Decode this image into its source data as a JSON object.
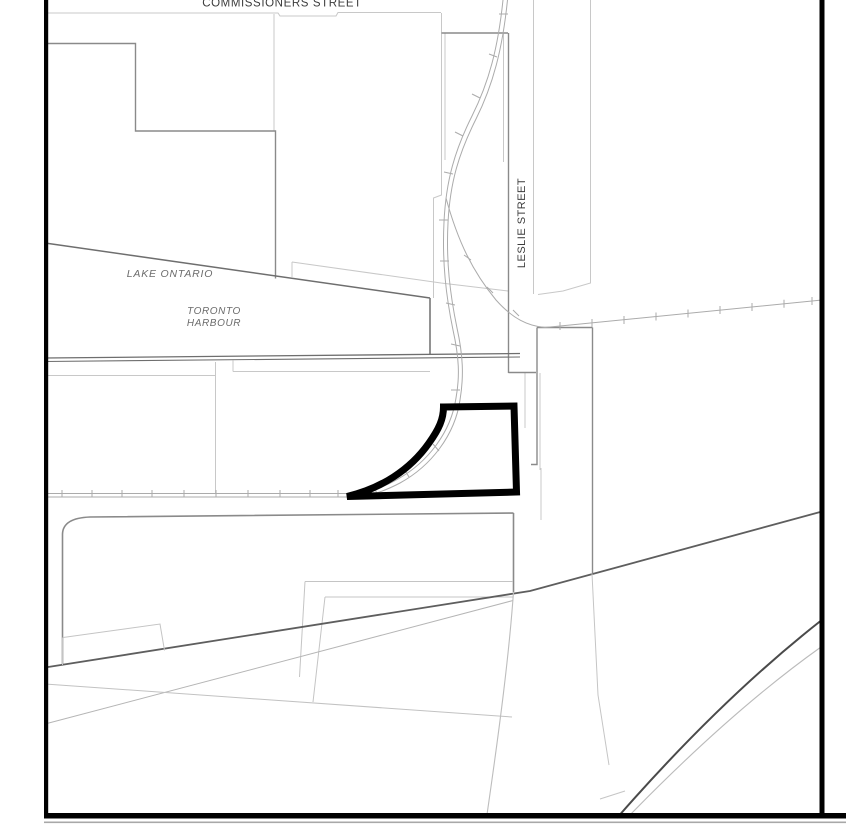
{
  "map": {
    "type": "site-location-plan",
    "labels": {
      "commissioners_street": "COMMISSIONERS STREET",
      "lake_ontario": "LAKE ONTARIO",
      "toronto_harbour_line1": "TORONTO",
      "toronto_harbour_line2": "HARBOUR",
      "leslie_street": "LESLIE STREET"
    },
    "colors": {
      "background": "#ffffff",
      "frame": "#000000",
      "subject_site_outline": "#000000",
      "parcel_light": "#c4c4c4",
      "parcel_medium": "#8a8a8a",
      "road_dark": "#555555",
      "rail_gray": "#aaaaaa",
      "water_edge": "#6e6e6e",
      "label_gray": "#6b6b6b",
      "label_dark": "#3c3c3c"
    }
  }
}
